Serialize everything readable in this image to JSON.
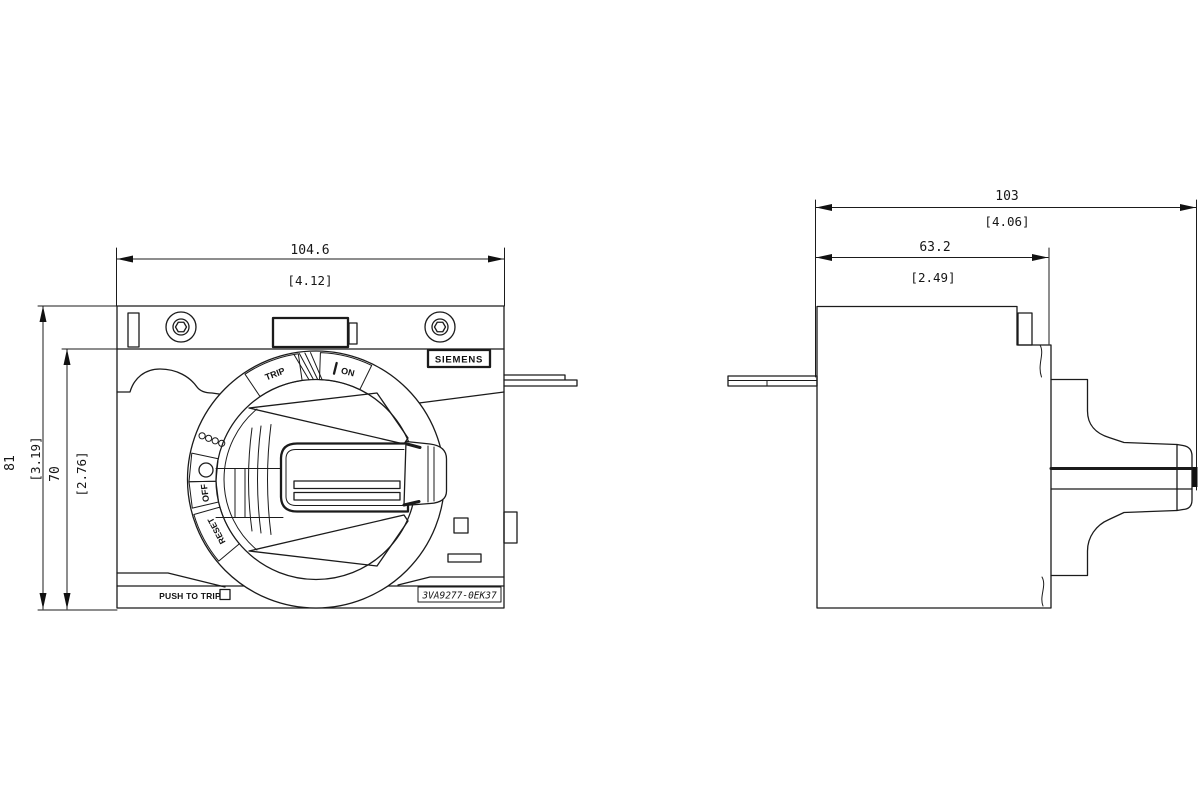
{
  "drawing": {
    "front_view": {
      "dim_width_mm": "104.6",
      "dim_width_in": "[4.12]",
      "dim_height_total_mm": "81",
      "dim_height_total_in": "[3.19]",
      "dim_height_body_mm": "70",
      "dim_height_body_in": "[2.76]",
      "brand_label": "SIEMENS",
      "push_to_trip_label": "PUSH TO TRIP",
      "part_number": "3VA9277-0EK37",
      "dial": {
        "on_label": "ON",
        "trip_label": "TRIP",
        "off_label": "OFF",
        "reset_label": "RESET"
      }
    },
    "side_view": {
      "dim_depth_total_mm": "103",
      "dim_depth_total_in": "[4.06]",
      "dim_depth_body_mm": "63.2",
      "dim_depth_body_in": "[2.49]"
    },
    "colors": {
      "line": "#1b1b1b",
      "background": "#ffffff"
    }
  }
}
